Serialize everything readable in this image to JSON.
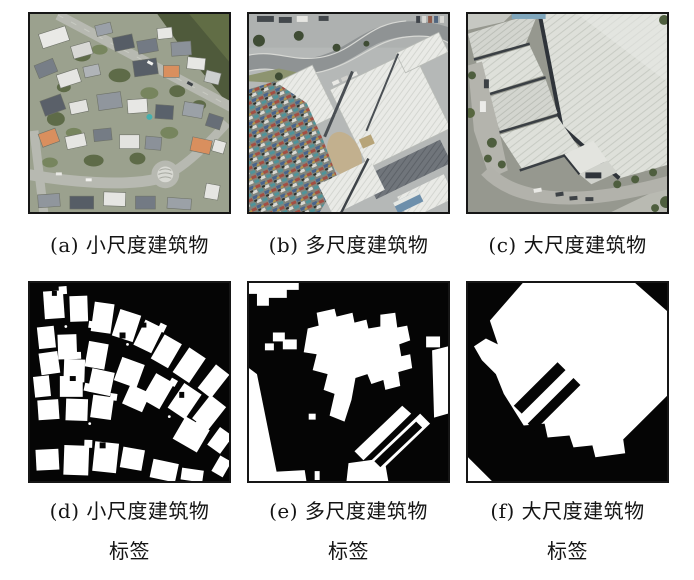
{
  "figure": {
    "captions_top": [
      {
        "text": "(a) 小尺度建筑物"
      },
      {
        "text": "(b) 多尺度建筑物"
      },
      {
        "text": "(c) 大尺度建筑物"
      }
    ],
    "captions_bottom": [
      {
        "line1": "(d) 小尺度建筑物",
        "line2": "标签"
      },
      {
        "line1": "(e) 多尺度建筑物",
        "line2": "标签"
      },
      {
        "line1": "(f) 大尺度建筑物",
        "line2": "标签"
      }
    ],
    "colors": {
      "page_background": "#ffffff",
      "panel_border": "#161616",
      "mask_background": "#050505",
      "mask_foreground": "#ffffff",
      "caption_text": "#141414"
    }
  }
}
